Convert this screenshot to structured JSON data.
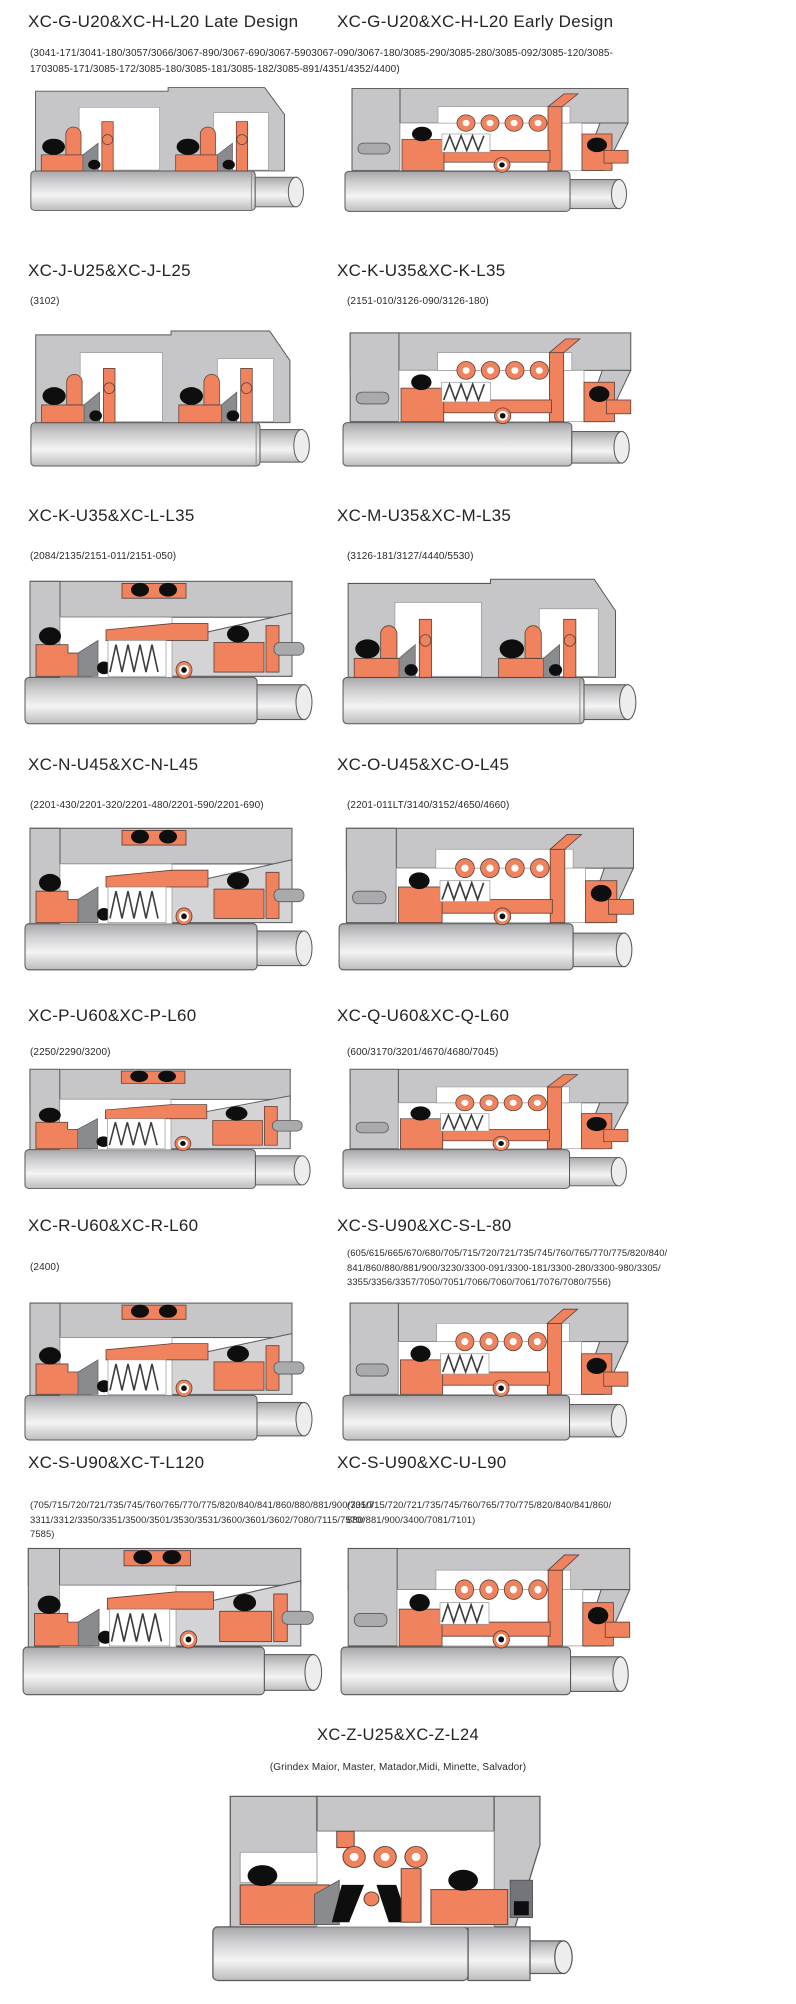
{
  "colors": {
    "housing_gray": "#c6c6c8",
    "gland_light_gray": "#d4d4d6",
    "seal_salmon": "#f0825e",
    "elastomer_black": "#0e0e0e",
    "wedge_gray": "#8a8b8f",
    "shaft_highlight": "#f4f4f4",
    "outline": "#58585a",
    "text": "#242424"
  },
  "rows": [
    {
      "left": {
        "title": "XC-G-U20&XC-H-L20 Late Design"
      },
      "right": {
        "title": "XC-G-U20&XC-H-L20 Early Design"
      },
      "shared_parts": "(3041-171/3041-180/3057/3066/3067-890/3067-690/3067-5903067-090/3067-180/3085-290/3085-280/3085-092/3085-120/3085-1703085-171/3085-172/3085-180/3085-181/3085-182/3085-891/4351/4352/4400)"
    },
    {
      "left": {
        "title": "XC-J-U25&XC-J-L25",
        "parts": "(3102)"
      },
      "right": {
        "title": "XC-K-U35&XC-K-L35",
        "parts": "(2151-010/3126-090/3126-180)"
      }
    },
    {
      "left": {
        "title": "XC-K-U35&XC-L-L35",
        "parts": "(2084/2135/2151-011/2151-050)"
      },
      "right": {
        "title": "XC-M-U35&XC-M-L35",
        "parts": "(3126-181/3127/4440/5530)"
      }
    },
    {
      "left": {
        "title": "XC-N-U45&XC-N-L45",
        "parts": "(2201-430/2201-320/2201-480/2201-590/2201-690)"
      },
      "right": {
        "title": "XC-O-U45&XC-O-L45",
        "parts": "(2201-011LT/3140/3152/4650/4660)"
      }
    },
    {
      "left": {
        "title": "XC-P-U60&XC-P-L60",
        "parts": "(2250/2290/3200)"
      },
      "right": {
        "title": "XC-Q-U60&XC-Q-L60",
        "parts": "(600/3170/3201/4670/4680/7045)"
      }
    },
    {
      "left": {
        "title": "XC-R-U60&XC-R-L60",
        "parts": "(2400)"
      },
      "right": {
        "title": "XC-S-U90&XC-S-L-80",
        "parts": "(605/615/665/670/680/705/715/720/721/735/745/760/765/770/775/820/840/841/860/880/881/900/3230/3300-091/3300-181/3300-280/3300-980/3305/3355/3356/3357/7050/7051/7066/7060/7061/7076/7080/7556)"
      }
    },
    {
      "left": {
        "title": "XC-S-U90&XC-T-L120",
        "parts": "(705/715/720/721/735/745/760/765/770/775/820/840/841/860/880/881/900/3310/3311/3312/3350/3351/3500/3501/3530/3531/3600/3601/3602/7080/7115/7570/7585)"
      },
      "right": {
        "title": "XC-S-U90&XC-U-L90",
        "parts": "(705/715/720/721/735/745/760/765/770/775/820/840/841/860/880/881/900/3400/7081/7101)"
      }
    }
  ],
  "bottom": {
    "title": "XC-Z-U25&XC-Z-L24",
    "parts": "(Grindex  Maior, Master, Matador,Midi, Minette, Salvador)"
  }
}
